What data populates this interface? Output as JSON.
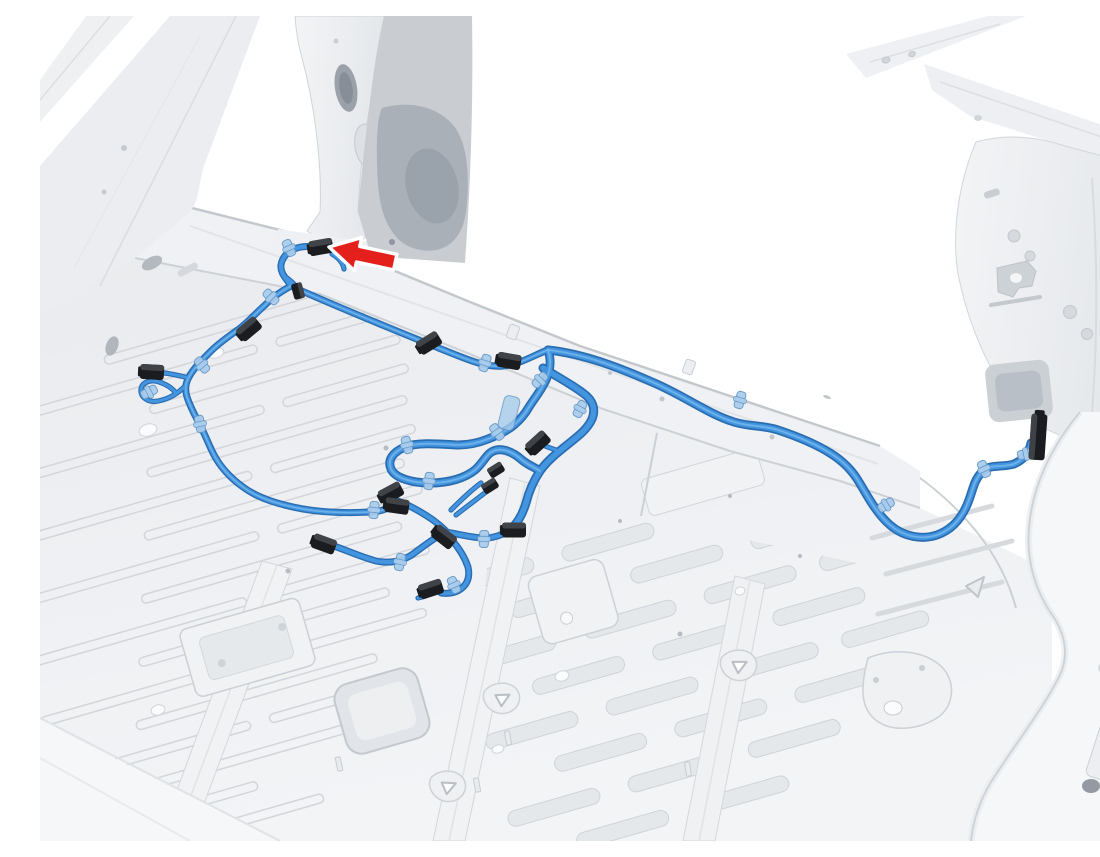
{
  "meta": {
    "title": "Wiring harness routing – rear floor",
    "description": "Grayscale 3D service illustration of a vehicle body-in-white rear interior viewed from above. A blue wiring harness runs from the left B-pillar base along the rocker sill to a connector on the right rear quarter panel, with branch circuits, a service loop and multiple black connectors spread across the rear floor pan. A red arrow callout points to a black harness connector at the left sill near the B-pillar base."
  },
  "callout": {
    "shape": "arrow",
    "direction": "left",
    "color_name": "red",
    "points_to": "harness connector at left sill near B-pillar base"
  },
  "harness": {
    "color_name": "blue",
    "connector_count": 16,
    "clip_count": 20,
    "main_runs": [
      "rocker sill run to right quarter panel connector",
      "left branch down floor with pigtail loop",
      "mid-floor service loop",
      "floor hub with multiple branch connectors"
    ]
  },
  "colors": {
    "background": "#ffffff",
    "harness_outline": "#2a6cb0",
    "harness_mid": "#4395e0",
    "harness_light": "#86c2f0",
    "clip_fill": "#a9cdec",
    "clip_stroke": "#6395c6",
    "connector_black": "#1a1c1f",
    "connector_face": "#45494e",
    "arrow_red": "#e3201b",
    "arrow_outline": "#ffffff",
    "body_fill": "#eceef1",
    "body_fill_light": "#f3f4f6",
    "body_fill_dark": "#dde0e4",
    "body_line": "#c8cdd2",
    "body_shadow": "#b8bdc3",
    "dark_recess": "#a3aab2",
    "floor_slot_fill": "#e5e8eb",
    "floor_slot_line": "#cfd3d8"
  }
}
